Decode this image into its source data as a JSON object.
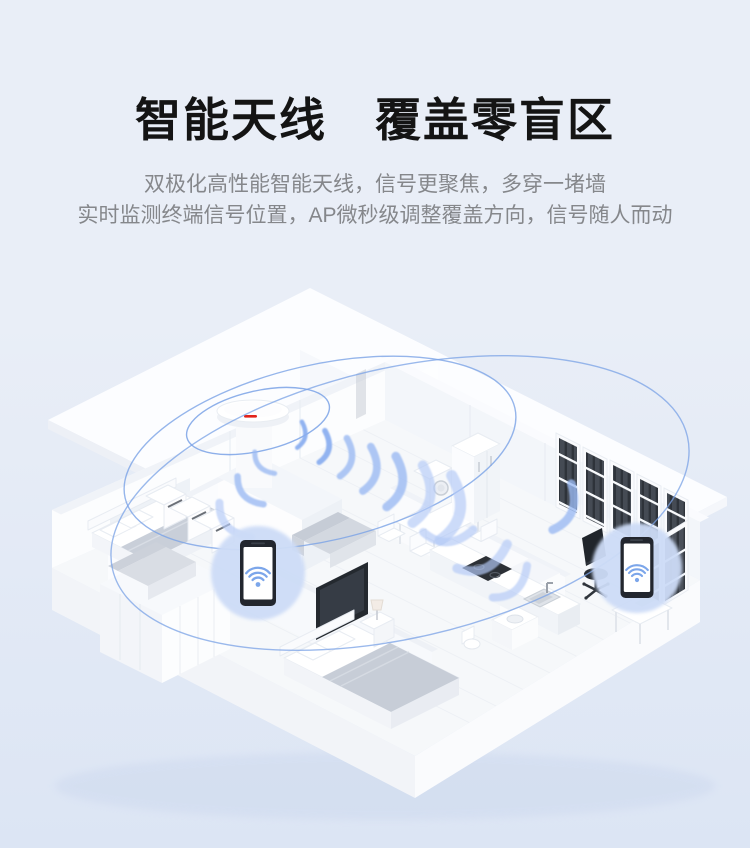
{
  "header": {
    "title": "智能天线　覆盖零盲区",
    "subtitle_line1": "双极化高性能智能天线，信号更聚焦，多穿一堵墙",
    "subtitle_line2": "实时监测终端信号位置，AP微秒级调整覆盖方向，信号随人而动"
  },
  "illustration": {
    "ap_device": {
      "name": "ceiling-mounted smart antenna AP",
      "brand_mark": "red-logo-stripe"
    },
    "signal": {
      "rings": 3,
      "beam_arcs": 14
    },
    "phones": [
      {
        "id": "phone-left",
        "screen_icon": "wifi-icon"
      },
      {
        "id": "phone-right",
        "screen_icon": "wifi-icon"
      }
    ]
  },
  "colors": {
    "bg-top": "#e9eef7",
    "bg-bottom": "#dce5f4",
    "title-color": "#141414",
    "subtitle-color": "#85878b",
    "signal-blue": "#7aa2e6",
    "beam-blue": "#93b4f0",
    "circle-blue": "#cddcf7",
    "wifi-blue": "#7ca6ea",
    "brand-red": "#e2231a"
  }
}
